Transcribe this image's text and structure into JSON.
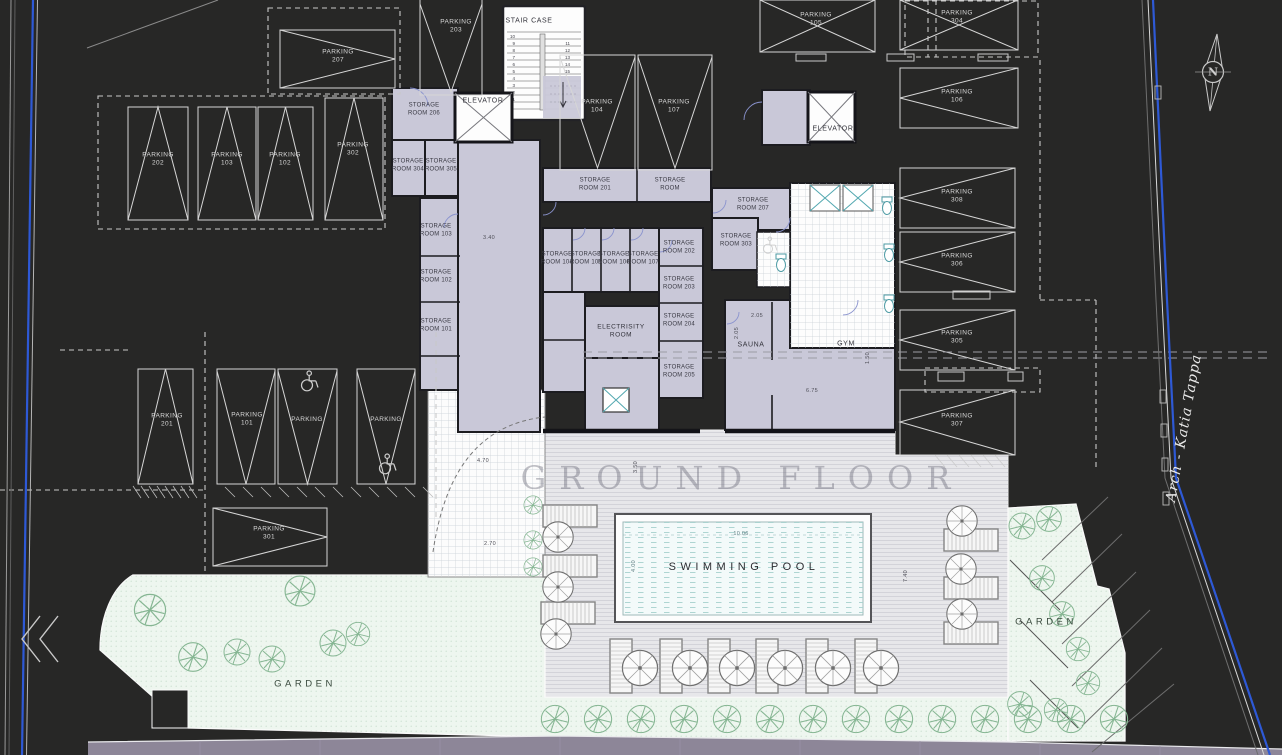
{
  "plan": {
    "watermark": "GROUND FLOOR",
    "street_name": "Arch - Katia Tappa",
    "compass_n": "N"
  },
  "rooms": {
    "stair_case": "STAIR CASE",
    "elevator_a": "ELEVATOR",
    "elevator_b": "ELEVATOR",
    "electricity_l1": "ELECTRISITY",
    "electricity_l2": "ROOM",
    "sauna": "SAUNA",
    "gym": "GYM",
    "swimming_pool": "SWIMMING POOL",
    "garden_left": "GARDEN",
    "garden_right": "GARDEN"
  },
  "parkings": [
    {
      "label": "PARKING",
      "num": "207"
    },
    {
      "label": "PARKING",
      "num": "203"
    },
    {
      "label": "PARKING",
      "num": "202"
    },
    {
      "label": "PARKING",
      "num": "103"
    },
    {
      "label": "PARKING",
      "num": "102"
    },
    {
      "label": "PARKING",
      "num": "302"
    },
    {
      "label": "PARKING",
      "num": "104"
    },
    {
      "label": "PARKING",
      "num": "107"
    },
    {
      "label": "PARKING",
      "num": "105"
    },
    {
      "label": "PARKING",
      "num": "304"
    },
    {
      "label": "PARKING",
      "num": "106"
    },
    {
      "label": "PARKING",
      "num": "308"
    },
    {
      "label": "PARKING",
      "num": "306"
    },
    {
      "label": "PARKING",
      "num": "305"
    },
    {
      "label": "PARKING",
      "num": "307"
    },
    {
      "label": "PARKING",
      "num": "201"
    },
    {
      "label": "PARKING",
      "num": "101"
    },
    {
      "label": "PARKING",
      "num": ""
    },
    {
      "label": "PARKING",
      "num": ""
    },
    {
      "label": "PARKING",
      "num": "301"
    }
  ],
  "storages": [
    {
      "l1": "STORAGE",
      "l2": "ROOM 206"
    },
    {
      "l1": "STORAGE",
      "l2": "ROOM 304"
    },
    {
      "l1": "STORAGE",
      "l2": "ROOM 305"
    },
    {
      "l1": "STORAGE",
      "l2": "ROOM 201"
    },
    {
      "l1": "STORAGE",
      "l2": "ROOM"
    },
    {
      "l1": "STORAGE",
      "l2": "ROOM 103"
    },
    {
      "l1": "STORAGE",
      "l2": "ROOM 102"
    },
    {
      "l1": "STORAGE",
      "l2": "ROOM 101"
    },
    {
      "l1": "STORAGE",
      "l2": "ROOM 104"
    },
    {
      "l1": "STORAGE",
      "l2": "ROOM 105"
    },
    {
      "l1": "STORAGE",
      "l2": "ROOM 106"
    },
    {
      "l1": "STORAGE",
      "l2": "ROOM 107"
    },
    {
      "l1": "STORAGE",
      "l2": "ROOM 202"
    },
    {
      "l1": "STORAGE",
      "l2": "ROOM 203"
    },
    {
      "l1": "STORAGE",
      "l2": "ROOM 204"
    },
    {
      "l1": "STORAGE",
      "l2": "ROOM 205"
    },
    {
      "l1": "STORAGE",
      "l2": "ROOM 207"
    },
    {
      "l1": "STORAGE",
      "l2": "ROOM 303"
    }
  ],
  "stairs": {
    "left": [
      "10",
      "9",
      "8",
      "7",
      "6",
      "5",
      "4",
      "3",
      "2",
      "1"
    ],
    "right": [
      "11",
      "12",
      "13",
      "14",
      "15"
    ]
  },
  "dimensions": {
    "corridor": "3.40",
    "entry": "4.70",
    "walk": "2.70",
    "sauna_w": "2.05",
    "sauna_h": "2.05",
    "gym_w": "6.75",
    "deck_v": "3.50",
    "gym_v": "1.50",
    "pool_len": "10.06",
    "pool_wid": "4.00",
    "deck_right": "7.40"
  },
  "colors": {
    "background": "#272726",
    "building_fill": "#c9c8d8",
    "boundary_blue": "#2e59d6",
    "garden_fill": "#eef6ef",
    "road_fill": "#8d8698",
    "pool_water": "#f3fafa"
  }
}
